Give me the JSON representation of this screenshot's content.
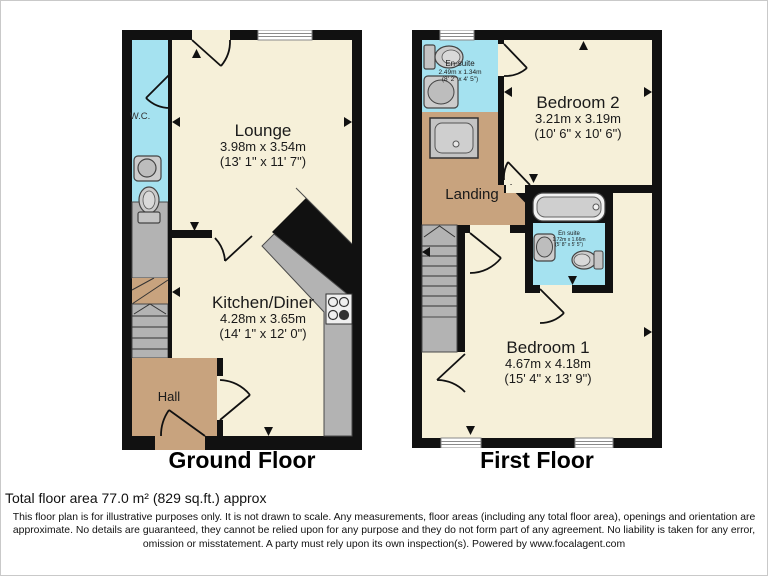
{
  "colors": {
    "wall": "#111111",
    "room_cream": "#F6F0D9",
    "wet_cyan": "#A5E2F0",
    "hall_tan": "#C8A37E",
    "fixture_gray": "#B3B3B3"
  },
  "ground_floor": {
    "label": "Ground Floor",
    "wc": {
      "name": "W.C."
    },
    "lounge": {
      "name": "Lounge",
      "metric": "3.98m x 3.54m",
      "imperial": "(13' 1\" x 11' 7\")"
    },
    "kitchen": {
      "name": "Kitchen/Diner",
      "metric": "4.28m x 3.65m",
      "imperial": "(14' 1\" x 12' 0\")"
    },
    "hall": {
      "name": "Hall"
    }
  },
  "first_floor": {
    "label": "First Floor",
    "ensuite1": {
      "name": "En-suite",
      "metric": "2.49m x 1.34m",
      "imperial": "(8' 2\" x 4' 5\")"
    },
    "bedroom2": {
      "name": "Bedroom 2",
      "metric": "3.21m x 3.19m",
      "imperial": "(10' 6\" x 10' 6\")"
    },
    "landing": {
      "name": "Landing"
    },
    "ensuite2": {
      "name": "En suite",
      "metric": "1.72m x 1.66m",
      "imperial": "(5' 8\" x 5' 5\")"
    },
    "bedroom1": {
      "name": "Bedroom 1",
      "metric": "4.67m x 4.18m",
      "imperial": "(15' 4\" x 13' 9\")"
    }
  },
  "footer": {
    "total_area": "Total floor area 77.0 m² (829 sq.ft.) approx",
    "disclaimer": "This floor plan is for illustrative purposes only. It is not drawn to scale. Any measurements, floor areas (including any total floor area), openings and orientation are approximate. No details are guaranteed, they cannot be relied upon for any purpose and they do not form part of any agreement. No liability is taken for any error, omission or misstatement. A party must rely upon its own inspection(s). Powered by www.focalagent.com"
  }
}
